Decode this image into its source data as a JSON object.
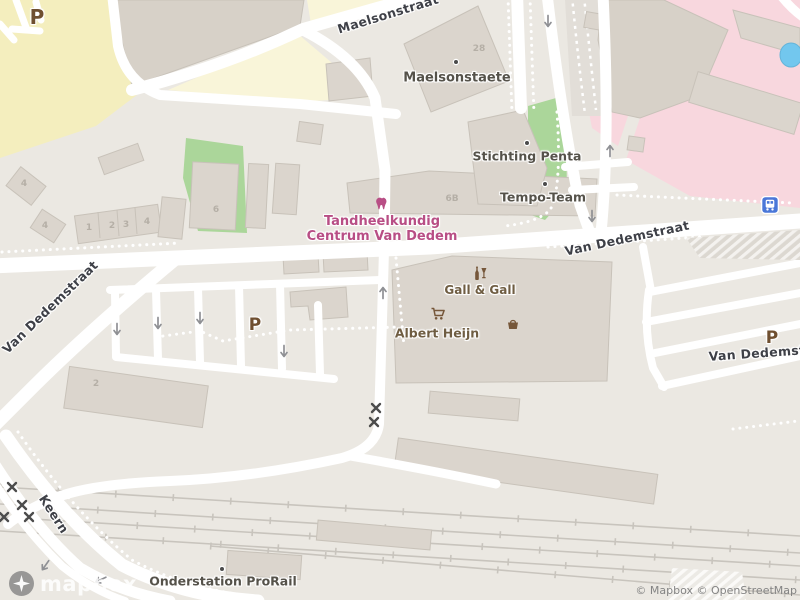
{
  "colors": {
    "land": "#ebe8e2",
    "road": "#ffffff",
    "building": "#dbd5cd",
    "buildingStroke": "#c8c2b9",
    "buildingDark": "#d7d1c8",
    "yellow": "#f4eebe",
    "paleYellow": "#f9f5d9",
    "pink": "#f8d7de",
    "green": "#abd69a",
    "water": "#72c7ee",
    "rail": "#c8c4bd",
    "band": "#e2ded8",
    "streetText": "#3e4047",
    "poiText": "#55524a",
    "shopText": "#6f5d42",
    "shopIcon": "#76573a",
    "dental": "#b84e85",
    "parkingBrown": "#6f4f30",
    "busBlue": "#4a77d8",
    "arrow": "#8f9094",
    "crossing": "#4c4c4c",
    "hatchBase": "#dcd8d1",
    "attrText": "#848484",
    "houseNum": "#b5afa6"
  },
  "labels": {
    "maelsonstraat": "Maelsonstraat",
    "van_dedemstraat_left": "Van Dedemstraat",
    "van_dedemstraat_center": "Van Dedemstraat",
    "van_dedemstraat_right": "Van Dedemstraat",
    "keern": "Keern",
    "maelsonstaete": "Maelsonstaete",
    "stichting_penta": "Stichting Penta",
    "tempo_team": "Tempo-Team",
    "tandheelkundig_line1": "Tandheelkundig",
    "tandheelkundig_line2": "Centrum Van Dedem",
    "gall_and_gall": "Gall & Gall",
    "albert_heijn": "Albert Heijn",
    "onderstation_prorail": "Onderstation ProRail",
    "parking_nw": "P",
    "parking_center": "P",
    "parking_east": "P",
    "num_28": "28",
    "num_6b": "6B",
    "num_4a": "4",
    "num_4b": "4",
    "num_1": "1",
    "num_2": "2",
    "num_3": "3",
    "num_4c": "4",
    "num_6": "6",
    "num_2b": "2"
  },
  "icons": {
    "dentist": "tooth-icon",
    "liquor_store": "bottle-and-glass-icon",
    "supermarket": "shopping-cart-icon",
    "shop": "basket-icon",
    "bus_stop": "bus-icon",
    "level_crossing": "x-cross-icon",
    "one_way": "arrow-icon",
    "logo_star": "mapbox-star-icon"
  },
  "footer": {
    "logo_text": "mapbox",
    "attribution": "© Mapbox © OpenStreetMap"
  }
}
